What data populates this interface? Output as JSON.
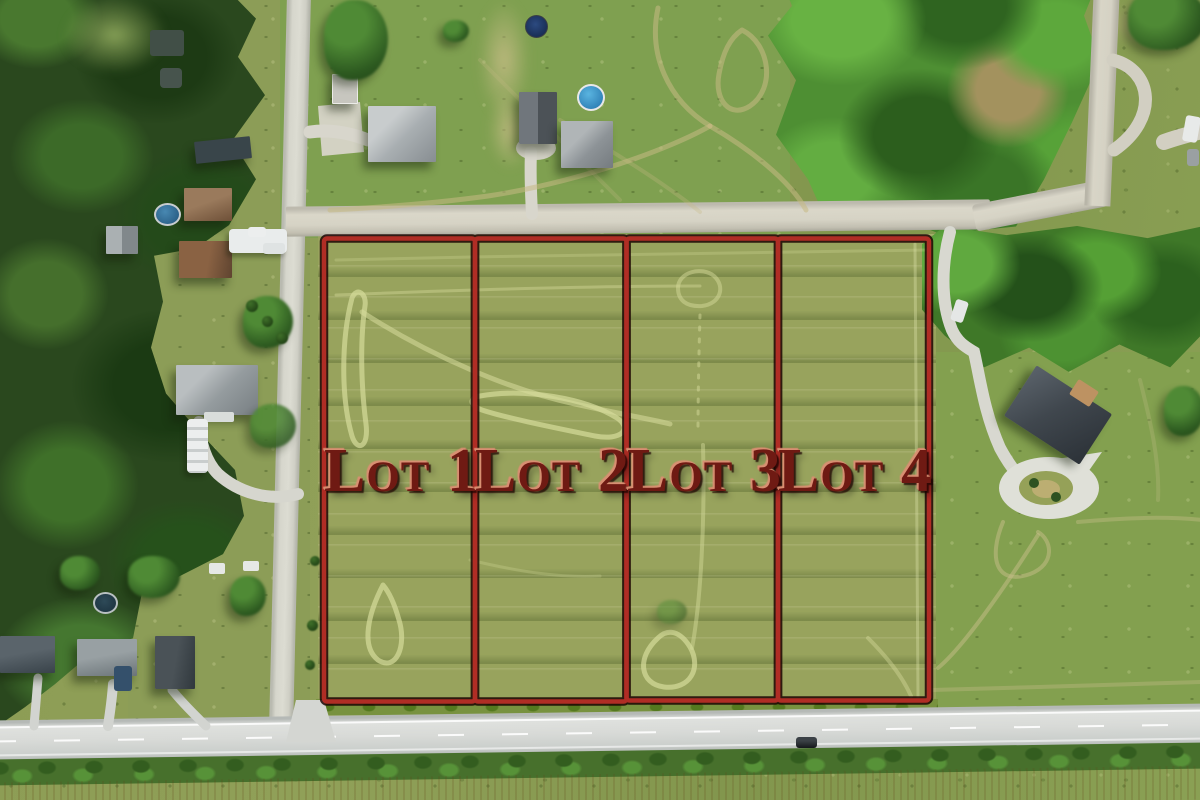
{
  "scene": {
    "description": "Aerial drone photo of four subdivided residential land lots outlined in red, between a gravel road (top) and a paved road (bottom), with forest at left, rural homes around, hedgerow and tan crop field along the bottom edge",
    "lots": [
      {
        "label": "Lot 1"
      },
      {
        "label": "Lot 2"
      },
      {
        "label": "Lot 3"
      },
      {
        "label": "Lot 4"
      }
    ],
    "colors": {
      "boundary_red": "#b02d25",
      "boundary_outline": "#1c0402",
      "label_red": "#6f1a13",
      "label_highlight": "#d98f72",
      "lot_grass": "#98a35d",
      "field_grass": "#84994f",
      "bright_trees": "#55a035",
      "forest": "#2a481e",
      "paved_road": "#d8dad7",
      "gravel_road": "#d6d3c5",
      "hedge": "#47702c",
      "crop_field_tan": "#c49a55",
      "pool_blue": "#4aa7d8"
    }
  }
}
